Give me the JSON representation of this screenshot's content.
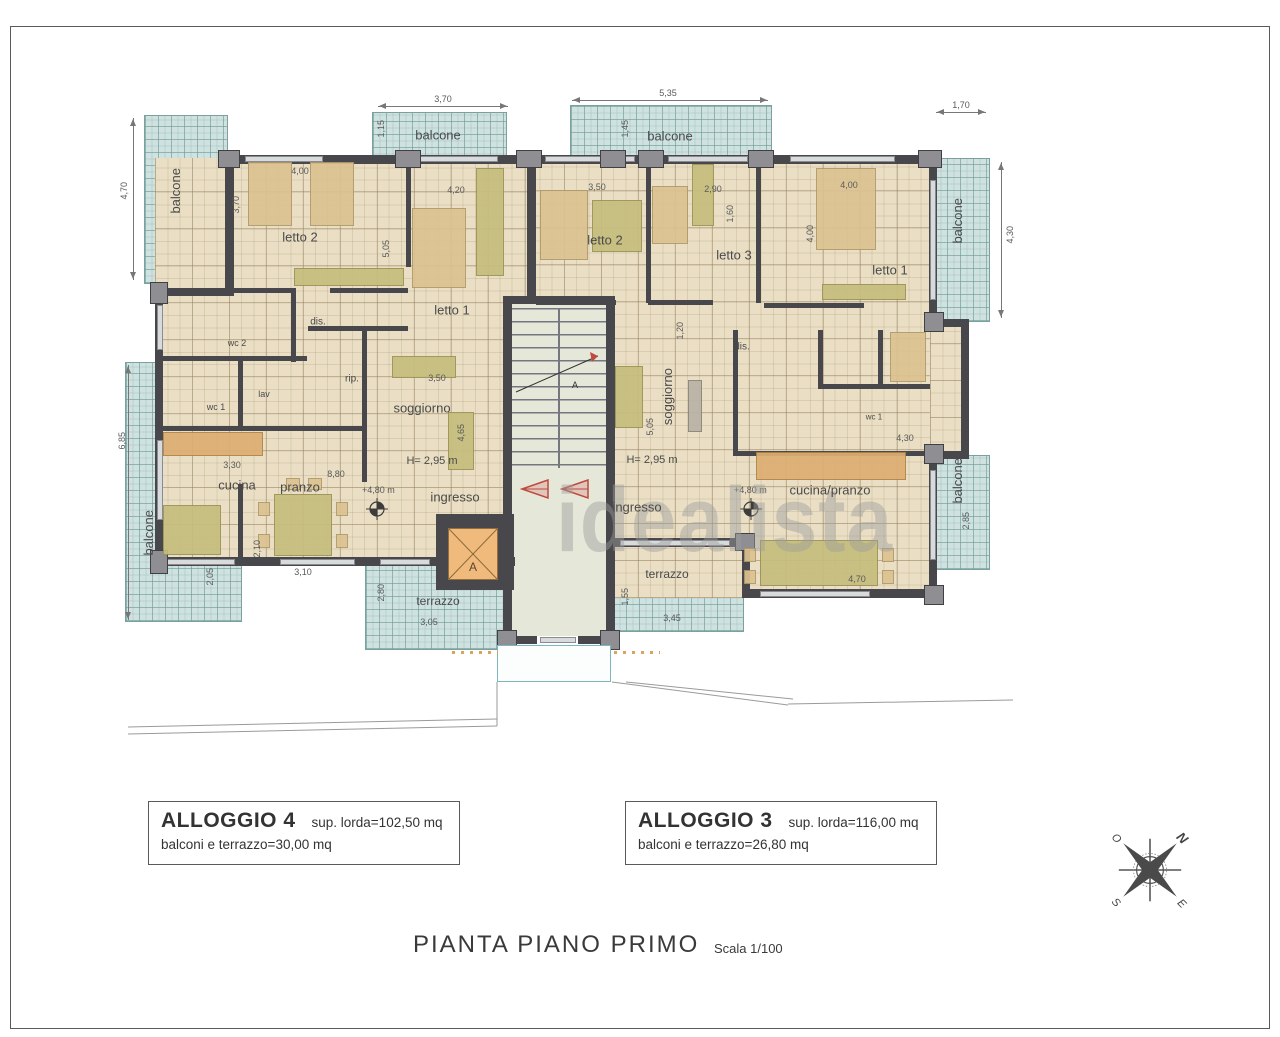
{
  "plan": {
    "labels": {
      "letto1": "letto 1",
      "letto2": "letto 2",
      "letto3": "letto 3",
      "dis": "dis.",
      "wc1": "wc 1",
      "wc2": "wc 2",
      "lav": "lav",
      "rip": "rip.",
      "soggiorno": "soggiorno",
      "height": "H= 2,95 m",
      "ingresso": "ingresso",
      "cucina": "cucina",
      "pranzo": "pranzo",
      "cucina_pranzo": "cucina/pranzo",
      "terrazzo": "terrazzo",
      "balcone": "balcone",
      "level": "+4,80 m",
      "lift": "A",
      "section": "A"
    },
    "dims": {
      "w115": "1,15",
      "w120": "1,20",
      "w145": "1,45",
      "w155": "1,55",
      "w160": "1,60",
      "w170": "1,70",
      "w205": "2,05",
      "w210": "2,10",
      "w280": "2,80",
      "w285": "2,85",
      "w290": "2,90",
      "w305": "3,05",
      "w310": "3,10",
      "w330": "3,30",
      "w345": "3,45",
      "w350": "3,50",
      "w370": "3,70",
      "w400": "4,00",
      "w420": "4,20",
      "w430": "4,30",
      "w465": "4,65",
      "w470": "4,70",
      "w505": "5,05",
      "w535": "5,35",
      "w685": "6,85",
      "w880": "8,80"
    },
    "watermark": "idealista"
  },
  "legend": {
    "apartments": [
      {
        "name": "ALLOGGIO 4",
        "gross": "sup. lorda=102,50 mq",
        "balconies": "balconi e terrazzo=30,00 mq"
      },
      {
        "name": "ALLOGGIO 3",
        "gross": "sup. lorda=116,00 mq",
        "balconies": "balconi e terrazzo=26,80 mq"
      }
    ]
  },
  "footer": {
    "title": "PIANTA PIANO PRIMO",
    "scale": "Scala 1/100"
  },
  "compass": {
    "n": "N",
    "o": "O",
    "s": "S",
    "e": "E"
  }
}
